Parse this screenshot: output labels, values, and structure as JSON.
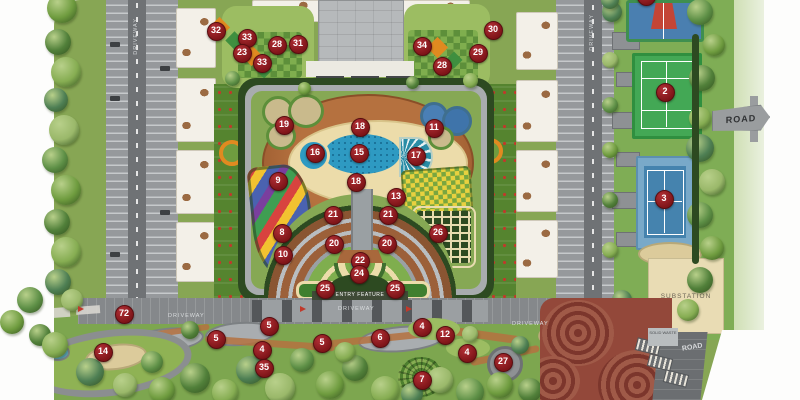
{
  "labels": {
    "road_sign": "ROAD",
    "road_bottom": "ROAD",
    "substation": "SUBSTATION",
    "solid_waste": "SOLID WASTE",
    "entry_feature": "ENTRY FEATURE",
    "driveway": "DRIVEWAY"
  },
  "colors": {
    "marker": "#7e1418",
    "lawn": "#87a654",
    "pool": "#2e9ac2",
    "deck": "#b5713f",
    "court_green": "#43a855",
    "court_blue": "#4583ae",
    "substation": "#e9dcb4",
    "plaza": "#93483a"
  },
  "markers": [
    {
      "n": "32",
      "x": 215,
      "y": 30
    },
    {
      "n": "33",
      "x": 246,
      "y": 37
    },
    {
      "n": "28",
      "x": 276,
      "y": 44
    },
    {
      "n": "31",
      "x": 297,
      "y": 43
    },
    {
      "n": "23",
      "x": 241,
      "y": 52
    },
    {
      "n": "33",
      "x": 261,
      "y": 62
    },
    {
      "n": "30",
      "x": 492,
      "y": 29
    },
    {
      "n": "34",
      "x": 421,
      "y": 45
    },
    {
      "n": "29",
      "x": 477,
      "y": 52
    },
    {
      "n": "28",
      "x": 441,
      "y": 65
    },
    {
      "n": "",
      "x": 645,
      "y": -5
    },
    {
      "n": "2",
      "x": 664,
      "y": 91
    },
    {
      "n": "3",
      "x": 663,
      "y": 198
    },
    {
      "n": "19",
      "x": 283,
      "y": 124
    },
    {
      "n": "18",
      "x": 359,
      "y": 126
    },
    {
      "n": "11",
      "x": 433,
      "y": 127
    },
    {
      "n": "16",
      "x": 314,
      "y": 152
    },
    {
      "n": "15",
      "x": 358,
      "y": 152
    },
    {
      "n": "17",
      "x": 415,
      "y": 155
    },
    {
      "n": "9",
      "x": 277,
      "y": 180
    },
    {
      "n": "18",
      "x": 355,
      "y": 181
    },
    {
      "n": "13",
      "x": 395,
      "y": 196
    },
    {
      "n": "21",
      "x": 332,
      "y": 214
    },
    {
      "n": "21",
      "x": 387,
      "y": 214
    },
    {
      "n": "8",
      "x": 281,
      "y": 232
    },
    {
      "n": "26",
      "x": 437,
      "y": 232
    },
    {
      "n": "20",
      "x": 333,
      "y": 243
    },
    {
      "n": "20",
      "x": 386,
      "y": 243
    },
    {
      "n": "10",
      "x": 282,
      "y": 254
    },
    {
      "n": "22",
      "x": 359,
      "y": 260
    },
    {
      "n": "24",
      "x": 358,
      "y": 273
    },
    {
      "n": "25",
      "x": 324,
      "y": 288
    },
    {
      "n": "25",
      "x": 394,
      "y": 288
    },
    {
      "n": "72",
      "x": 123,
      "y": 313
    },
    {
      "n": "5",
      "x": 268,
      "y": 325
    },
    {
      "n": "4",
      "x": 421,
      "y": 326
    },
    {
      "n": "12",
      "x": 444,
      "y": 334
    },
    {
      "n": "6",
      "x": 379,
      "y": 337
    },
    {
      "n": "5",
      "x": 215,
      "y": 338
    },
    {
      "n": "5",
      "x": 321,
      "y": 342
    },
    {
      "n": "4",
      "x": 261,
      "y": 349
    },
    {
      "n": "14",
      "x": 102,
      "y": 351
    },
    {
      "n": "4",
      "x": 466,
      "y": 352
    },
    {
      "n": "27",
      "x": 502,
      "y": 361
    },
    {
      "n": "35",
      "x": 263,
      "y": 367
    },
    {
      "n": "7",
      "x": 421,
      "y": 379
    }
  ]
}
